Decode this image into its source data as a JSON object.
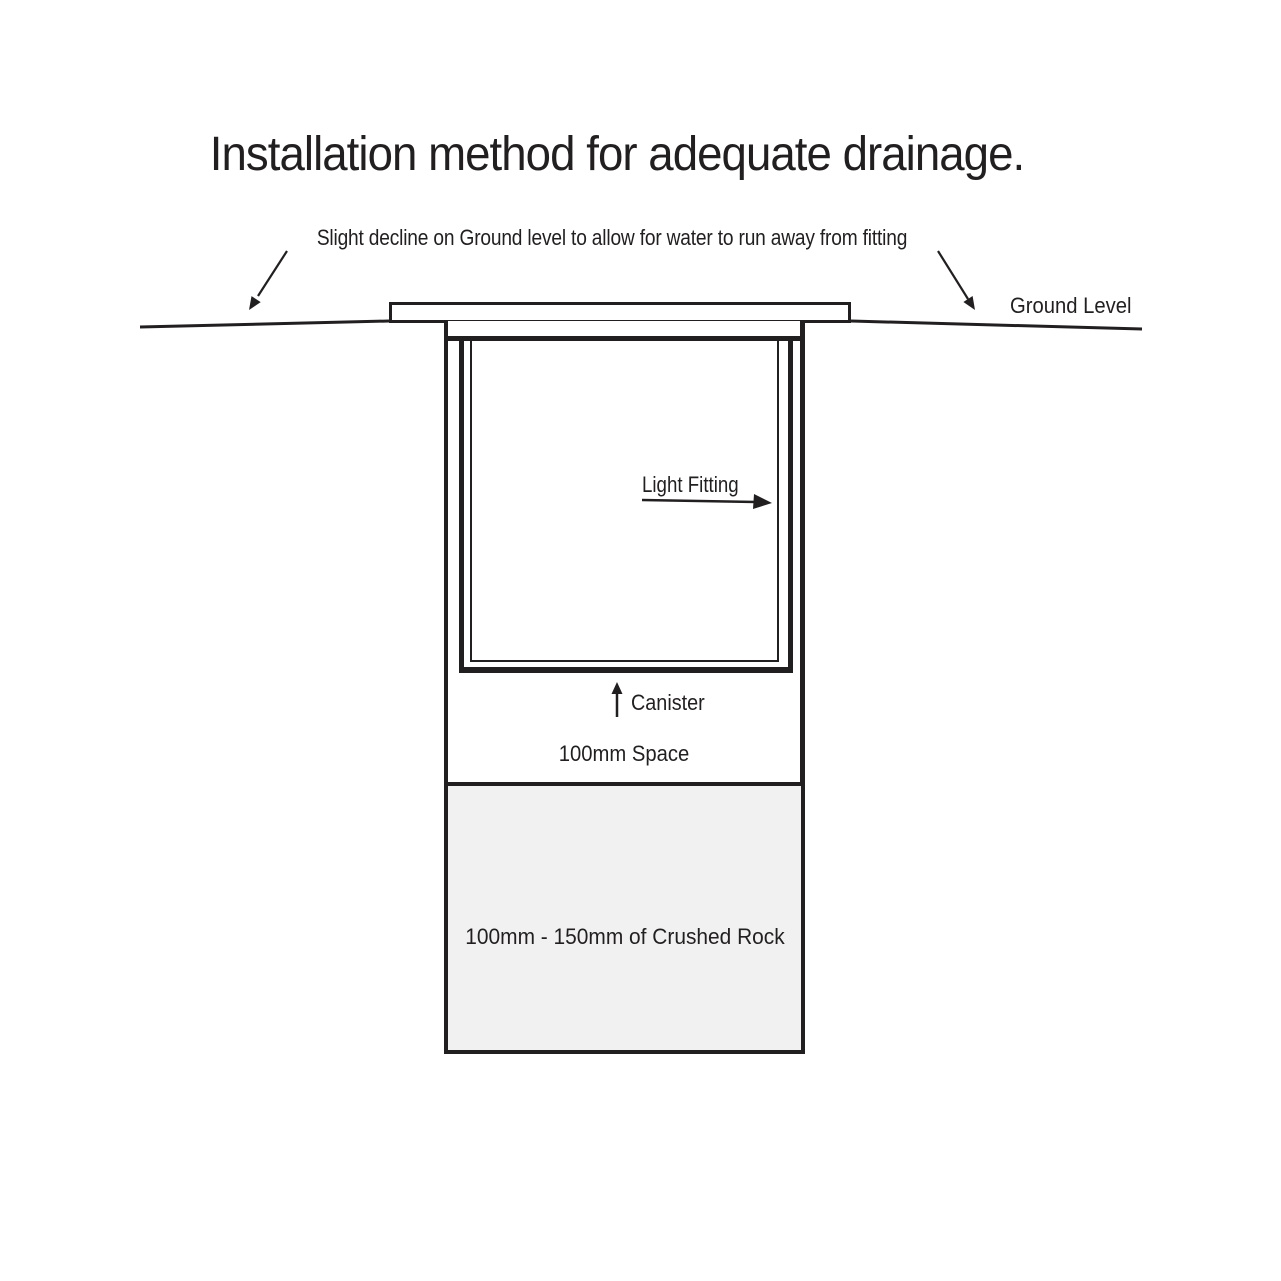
{
  "title": "Installation method for adequate drainage.",
  "labels": {
    "decline_note": "Slight decline on Ground level to allow for water to run away from fitting",
    "ground_level": "Ground Level",
    "light_fitting": "Light Fitting",
    "canister": "Canister",
    "space": "100mm Space",
    "crushed_rock": "100mm - 150mm of Crushed Rock"
  },
  "colors": {
    "ink": "#221f20",
    "rock_fill": "#f1f1f1",
    "background": "#ffffff"
  }
}
